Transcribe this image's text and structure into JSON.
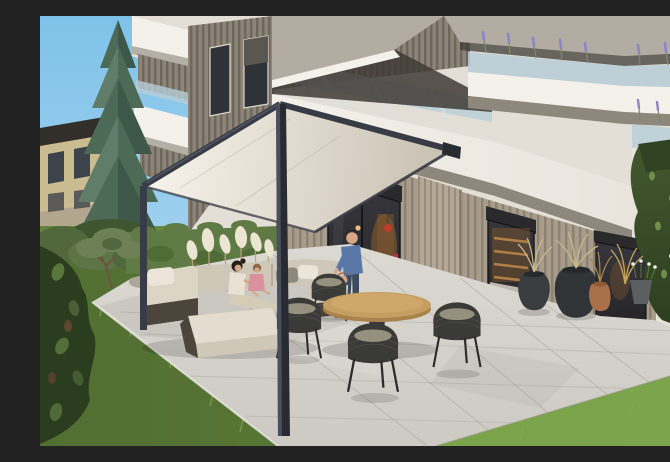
{
  "scene": {
    "title": "Modern apartment building exterior with covered garden terrace",
    "description": "Architectural rendering of a modern multi-storey apartment building with white balcony bands, glass balustrades planted with lavender and grasses, a dark pergola with a light canopy over a stone patio, an outdoor lounge sofa where a woman and child sit, a man with a small child by the glass doors, a round wooden dining table with black rope chairs, planted pots, a lawn, a hedge, a tall spruce and a neighbouring house.",
    "elements": [
      "sky",
      "neighbouring-house",
      "spruce-tree",
      "apartment-building",
      "balcony-planting",
      "pergola",
      "canopy",
      "patio",
      "outdoor-sofa",
      "dining-table",
      "rope-chairs",
      "planted-pots",
      "lawn",
      "hedge",
      "pampas-grass",
      "residents"
    ]
  },
  "palette": {
    "sky1": "#7fc2e9",
    "sky2": "#bcdef2",
    "houseWall": "#cbbb90",
    "houseRoof": "#322f2a",
    "houseWin": "#3d434a",
    "houseBalc": "#b2a78e",
    "houseBase": "#dad4c7",
    "spruceDark": "#3d5848",
    "spruceMid": "#4d6a57",
    "spruceLight": "#607d69",
    "trunk": "#4a392b",
    "bush1": "#51683c",
    "bush2": "#3f5530",
    "bush3": "#5d7546",
    "grassBase": "#63843a",
    "grassBright": "#7ba44b",
    "grassShadow": "#42592a",
    "grassBlade": "#86ab55",
    "hedge1": "#5f7a45",
    "hedge2": "#47602f",
    "rock1": "#aca69b",
    "rock2": "#968e81",
    "treeOlive": "#6e8055",
    "treeTrunk": "#6b5540",
    "pampas": "#ece5d2",
    "pampasStem": "#b7a678",
    "backdrop": "#e3ded6",
    "wallRight": "#e8e3da",
    "slabWhite": "#f4f1ea",
    "slabWhite2": "#e9e4dc",
    "slabUnder": "#b5b0a6",
    "ceilGray": "#b3aca2",
    "soffit": "#8e877c",
    "shadowBand": "#3f3b35",
    "glass": "#b7cdd8",
    "glassHi": "#dbe7ec",
    "woodBase": "#8d8478",
    "woodStripe": "#6f675c",
    "gfBase": "#a89c8b",
    "gfStripe": "#8d8173",
    "pillarBase": "#b3a795",
    "pillarStripe": "#998c7a",
    "winDark": "#2f3338",
    "winFrame": "#ddd8cf",
    "shutterHalf": "#5a5650",
    "lavender": "#8d86c6",
    "lavStem": "#7d8a64",
    "dryGrass": "#c9b88c",
    "canopy1": "#f7f3eb",
    "canopy2": "#c9c1b2",
    "canopyFold": "#b9b1a2",
    "pergola": "#383c46",
    "pergolaHi": "#59606f",
    "pergolaDark": "#282b32",
    "patio1": "#dcd9d3",
    "patio2": "#cdcac3",
    "patioLine": "#b0aca4",
    "patioEdge": "#eceae5",
    "shutter": "#2a2a2d",
    "doorDark": "#26262a",
    "doorDark2": "#36363c",
    "frameDark": "#161619",
    "glow": "#f2bd74",
    "glowSoft": "#8a5c2e",
    "redLamp": "#c23b2c",
    "shelf": "#c08a4a",
    "cabinet": "#cfc8bd",
    "innerSofa": "#8d8578",
    "sofaA": "#dcd4c5",
    "sofaB": "#cfc7b7",
    "sofaC": "#e4ddcf",
    "sofaBase": "#4b453c",
    "pillowW": "#ece6da",
    "pillowG": "#8e887a",
    "tableTop": "#c79e62",
    "tableEdge": "#a9824c",
    "tableHi": "#d4ad70",
    "tableLeg": "#3a3a38",
    "chair": "#3a3a38",
    "chairHi": "#5b584f",
    "cushion": "#96907e",
    "chairLeg": "#2c2c2a",
    "potDark": "#3a3d40",
    "potDark2": "#313437",
    "potRim": "#26292c",
    "terracotta": "#a9714a",
    "potGray": "#5c5f62",
    "greenery1": "#44592f",
    "greenery2": "#2b3d1f",
    "leaf": "#6f8f4a",
    "goldGrass": "#c2a45e",
    "skin": "#d7a888",
    "hairDark": "#261e16",
    "shirtBlue": "#5978a8",
    "jeans": "#3b4a5f",
    "hairRed": "#9c5230",
    "outfitLight": "#e4dfd3",
    "pinkTop": "#d9919f",
    "creamTop": "#e9e2d4",
    "pantsLight": "#d5ccb8",
    "hairBrown": "#8a6848",
    "bouquet": "#c8454f",
    "bouquetDark": "#a83540",
    "stemGreen": "#5a7a3c"
  }
}
